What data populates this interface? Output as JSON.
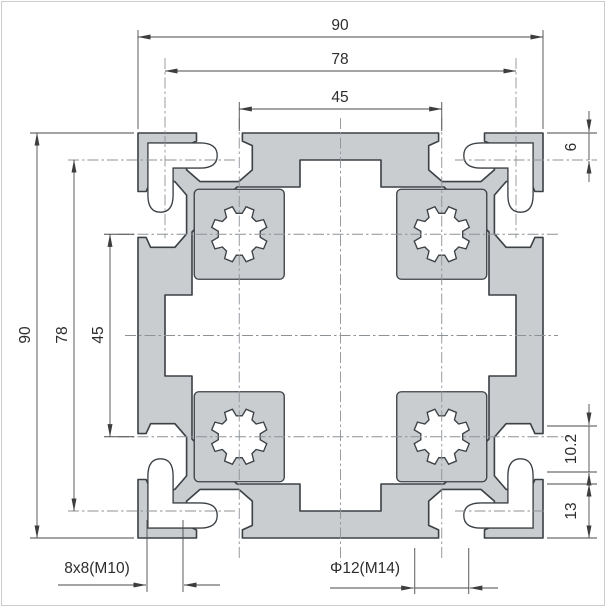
{
  "drawing": {
    "type": "extrusion-profile-cross-section",
    "dims": {
      "width_total": "90",
      "width_corner_slots": "78",
      "width_boss_centers": "45",
      "height_total": "90",
      "height_corner_slots": "78",
      "height_boss_centers": "45",
      "corner_slot_offset": "6",
      "slot_mouth_width": "10.2",
      "corner_width": "13",
      "corner_slot_spec": "8x8(M10)",
      "center_bore_spec": "Φ12(M14)"
    },
    "colors": {
      "profile_fill": "#cacdd0",
      "profile_outline": "#3c4146",
      "dimension_lines": "#4a4a4a",
      "centerlines": "#8d9296"
    }
  }
}
